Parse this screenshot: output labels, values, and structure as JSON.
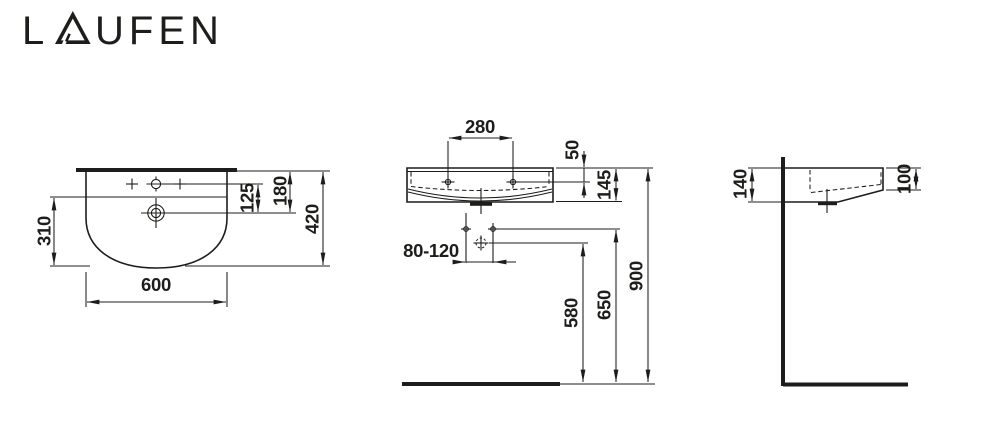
{
  "logo": {
    "text": "LAUFEN",
    "prefix": "L",
    "suffix": "UFEN"
  },
  "drawing": {
    "colors": {
      "line": "#1d1d1b",
      "background": "#ffffff"
    },
    "views": {
      "plan": {
        "dims": {
          "width": "600",
          "depth": "420",
          "bowl_depth": "310",
          "tap_to_drain": "125",
          "edge_to_drain": "180"
        }
      },
      "front": {
        "dims": {
          "hole_spacing": "280",
          "rim_to_hole": "50",
          "height": "145",
          "fixing_spacing": "80-120",
          "outlet_height": "580",
          "fixing_height": "650",
          "rim_height": "900"
        }
      },
      "side": {
        "dims": {
          "depth_at_wall": "140",
          "front_edge_height": "100"
        }
      }
    }
  }
}
